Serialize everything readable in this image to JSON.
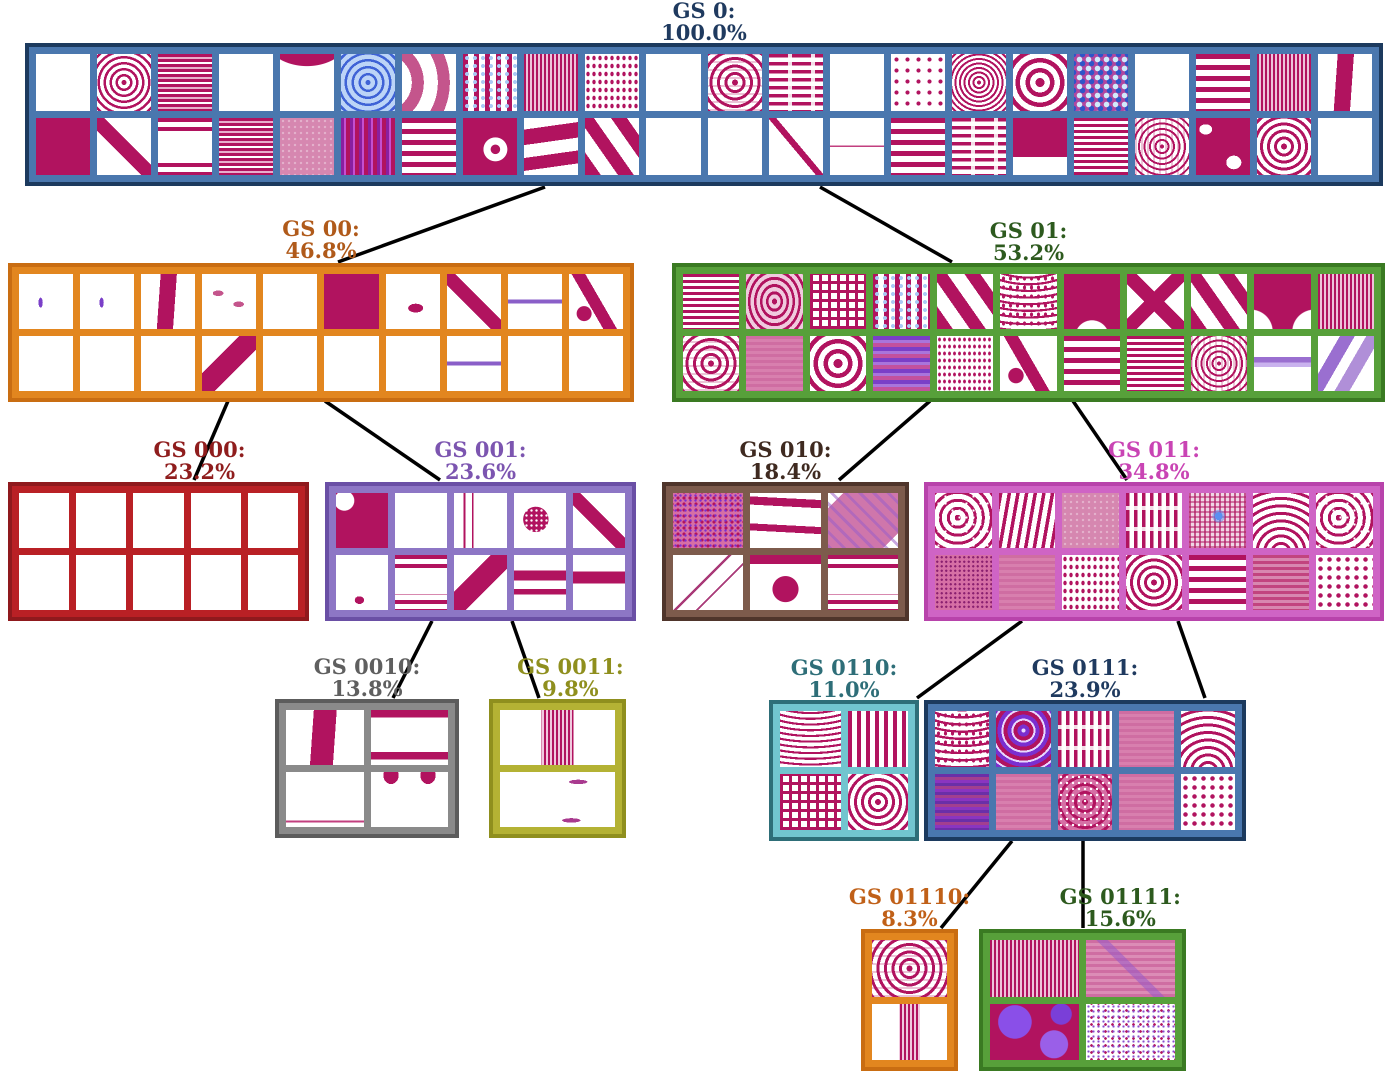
{
  "figure": {
    "description": "Hierarchical clustering tree of Gray-Scott pattern classes with population percentages",
    "nodes": {
      "gs0": {
        "label": "GS 0:",
        "percent": "100.0%",
        "colors": {
          "text": "#1f3a5f",
          "fill": "#4a77ae",
          "border": "#1c3a5e"
        },
        "grid": {
          "cols": 22,
          "rows": 2
        },
        "tiles": [
          [
            "blank",
            "rings",
            "hstripes_pink",
            "blank",
            "wave_top",
            "blue_bullseye",
            "chevron",
            "blue_dot_columns",
            "vstripes_fine",
            "dot_rows",
            "blank",
            "sq_rings",
            "h_maze",
            "blank",
            "dots_sparse",
            "rings_fine",
            "bullseye_bold",
            "blue_camo",
            "blank",
            "hstripes_bold",
            "vstripes_fine",
            "vertical_wave"
          ],
          [
            "solid",
            "diag_bar",
            "hstripes_edges",
            "hstripes_pink",
            "pink_texture",
            "vstripes_purple",
            "hstripes_bold",
            "solid_dot",
            "wave_blobs",
            "diag_bold",
            "blank",
            "blank",
            "diag_bar_thin",
            "hline_mid",
            "hstripes_bold",
            "h_maze",
            "solid_band",
            "hstripes",
            "sq_rings_fine",
            "solid_blobs",
            "bullseye",
            "blank"
          ]
        ]
      },
      "gs00": {
        "label": "GS 00:",
        "percent": "46.8%",
        "colors": {
          "text": "#b05a1a",
          "fill": "#e2861f",
          "border": "#c96d12"
        },
        "grid": {
          "cols": 10,
          "rows": 2
        },
        "tiles": [
          [
            "speck",
            "speck",
            "vertical_wave",
            "dashes",
            "blank",
            "solid",
            "comma",
            "diag_bar",
            "purple_line",
            "snake"
          ],
          [
            "blank",
            "blank",
            "blank",
            "diag_band",
            "blank",
            "blank",
            "blank",
            "purple_line",
            "blank",
            "blank"
          ]
        ]
      },
      "gs01": {
        "label": "GS 01:",
        "percent": "53.2%",
        "colors": {
          "text": "#2d5a1e",
          "fill": "#57a03a",
          "border": "#3a7a22"
        },
        "grid": {
          "cols": 11,
          "rows": 2
        },
        "tiles": [
          [
            "hstripes",
            "oval_rings",
            "maze",
            "blue_dot_columns",
            "diag_bold",
            "arcs_dots",
            "notch",
            "diag_x",
            "diag_bold",
            "bell",
            "vstripes_fine"
          ],
          [
            "sq_rings",
            "pink_haze",
            "bullseye_bold",
            "purple_haze",
            "diag_dots",
            "snake",
            "hstripes_bold",
            "hstripes",
            "sq_rings_fine",
            "hband_purple",
            "diag_bands_purple"
          ]
        ]
      },
      "gs000": {
        "label": "GS 000:",
        "percent": "23.2%",
        "colors": {
          "text": "#8f1d1d",
          "fill": "#b92025",
          "border": "#8f191d"
        },
        "grid": {
          "cols": 5,
          "rows": 2
        },
        "tiles": [
          [
            "blank",
            "blank",
            "blank",
            "blank",
            "blank"
          ],
          [
            "blank",
            "blank",
            "blank",
            "blank",
            "blank"
          ]
        ]
      },
      "gs001": {
        "label": "GS 001:",
        "percent": "23.6%",
        "colors": {
          "text": "#7c55b0",
          "fill": "#8d76c5",
          "border": "#6a4fa5"
        },
        "grid": {
          "cols": 5,
          "rows": 2
        },
        "tiles": [
          [
            "solid_hole",
            "wave_bottom",
            "v_curves",
            "blob_dots",
            "diag_bar"
          ],
          [
            "speck_dot",
            "hstripes_edges",
            "diag_band",
            "hbars_mid",
            "hbar"
          ]
        ]
      },
      "gs010": {
        "label": "GS 010:",
        "percent": "18.4%",
        "colors": {
          "text": "#3f2a20",
          "fill": "#7d5b4c",
          "border": "#4f352b"
        },
        "grid": {
          "cols": 3,
          "rows": 2
        },
        "tiles": [
          [
            "dots_texture",
            "wavy_bands",
            "diag_texture"
          ],
          [
            "diag_lines_thin",
            "circle_bar",
            "hstripes_edges"
          ]
        ]
      },
      "gs011": {
        "label": "GS 011:",
        "percent": "34.8%",
        "colors": {
          "text": "#c944b4",
          "fill": "#cf64c5",
          "border": "#b843ab"
        },
        "grid": {
          "cols": 7,
          "rows": 2
        },
        "tiles": [
          [
            "maze_dots",
            "wavestripes",
            "pink_texture",
            "v_maze",
            "grid_blue",
            "fingerprint",
            "maze_dots"
          ],
          [
            "fine_dots",
            "pink_haze",
            "dot_rows",
            "bullseye",
            "hstripes_bold",
            "hstripes_haze",
            "dot_field"
          ]
        ]
      },
      "gs0010": {
        "label": "GS 0010:",
        "percent": "13.8%",
        "colors": {
          "text": "#5f5f5f",
          "fill": "#8a8a8a",
          "border": "#5c5c5c"
        },
        "grid": {
          "cols": 2,
          "rows": 2
        },
        "tiles": [
          [
            "vertical_wave",
            "hbars_tb"
          ],
          [
            "hline_bottom",
            "horns"
          ]
        ]
      },
      "gs0011": {
        "label": "GS 0011:",
        "percent": "9.8%",
        "colors": {
          "text": "#8f8f1e",
          "fill": "#b4b234",
          "border": "#8f8f1e"
        },
        "grid": {
          "cols": 1,
          "rows": 2
        },
        "tiles": [
          [
            "vband_striped"
          ],
          [
            "specks"
          ]
        ]
      },
      "gs0110": {
        "label": "GS 0110:",
        "percent": "11.0%",
        "colors": {
          "text": "#2e6e78",
          "fill": "#72c5cf",
          "border": "#2e6e78"
        },
        "grid": {
          "cols": 2,
          "rows": 2
        },
        "tiles": [
          [
            "arcs",
            "vstripes"
          ],
          [
            "maze",
            "bullseye"
          ]
        ]
      },
      "gs0111": {
        "label": "GS 0111:",
        "percent": "23.9%",
        "colors": {
          "text": "#1f3a5f",
          "fill": "#4a77ae",
          "border": "#1c3a5e"
        },
        "grid": {
          "cols": 5,
          "rows": 2
        },
        "tiles": [
          [
            "arcs_dots",
            "purple_bullseye",
            "v_maze",
            "pink_haze",
            "fingerprint"
          ],
          [
            "purple_stripes",
            "pink_haze",
            "sq_rings_dots",
            "pink_haze",
            "dot_field"
          ]
        ]
      },
      "gs01110": {
        "label": "GS 01110:",
        "percent": "8.3%",
        "colors": {
          "text": "#c06018",
          "fill": "#e2861f",
          "border": "#c96d12"
        },
        "grid": {
          "cols": 1,
          "rows": 2
        },
        "tiles": [
          [
            "sq_rings"
          ],
          [
            "vband_striped"
          ]
        ]
      },
      "gs01111": {
        "label": "GS 01111:",
        "percent": "15.6%",
        "colors": {
          "text": "#2d5a1e",
          "fill": "#57a03a",
          "border": "#3a7a22"
        },
        "grid": {
          "cols": 2,
          "rows": 2
        },
        "tiles": [
          [
            "vstripes_fine",
            "pink_haze_diag"
          ],
          [
            "purple_blobs",
            "speckle_white"
          ]
        ]
      }
    },
    "edges": [
      [
        "gs0",
        "gs00"
      ],
      [
        "gs0",
        "gs01"
      ],
      [
        "gs00",
        "gs000"
      ],
      [
        "gs00",
        "gs001"
      ],
      [
        "gs01",
        "gs010"
      ],
      [
        "gs01",
        "gs011"
      ],
      [
        "gs001",
        "gs0010"
      ],
      [
        "gs001",
        "gs0011"
      ],
      [
        "gs011",
        "gs0110"
      ],
      [
        "gs011",
        "gs0111"
      ],
      [
        "gs0111",
        "gs01110"
      ],
      [
        "gs0111",
        "gs01111"
      ]
    ]
  }
}
